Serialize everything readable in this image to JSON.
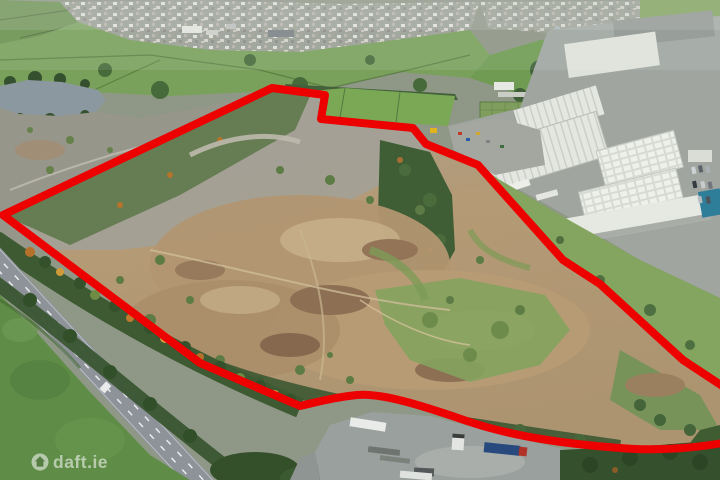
{
  "watermark": {
    "text": "daft.ie",
    "icon": "daft-house-icon",
    "color": "#ffffff"
  },
  "boundary": {
    "color": "#ed0000",
    "stroke_width": 8,
    "path": "M 3,215 L 272,88 L 325,95 L 321,119 L 413,128 L 426,144 L 478,165 L 563,260 L 600,284 L 683,360 L 748,403 L 748,438 C 700,449 655,451 620,448 C 567,444 515,437 470,422 C 440,412 385,392 357,395 C 337,397 317,402 300,406 L 200,363 Z"
  },
  "palette": {
    "boundary_red": "#ed0000",
    "site_earth": "#b29672",
    "site_gravel": "#a3a096",
    "field_green": "#7aa15b",
    "forest_green": "#3f5e35",
    "road_grey": "#8e9399",
    "roof_white": "#e3e6df",
    "lake_grey": "#8c98a0",
    "teal_building": "#2e7d99"
  }
}
